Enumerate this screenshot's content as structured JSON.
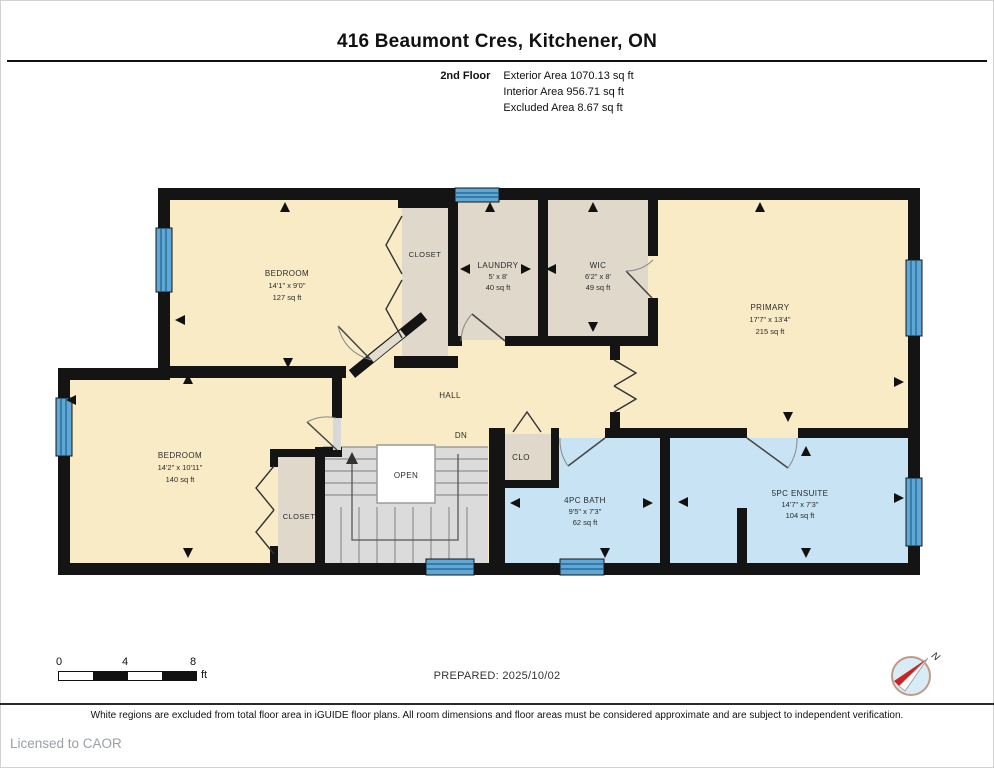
{
  "header": {
    "title": "416 Beaumont Cres, Kitchener, ON",
    "floor_label": "2nd Floor",
    "stats": [
      "Exterior Area 1070.13 sq ft",
      "Interior Area 956.71 sq ft",
      "Excluded Area 8.67 sq ft"
    ]
  },
  "rooms": {
    "bedroom_top": {
      "name": "BEDROOM",
      "dims": "14'1\" x 9'0\"",
      "area": "127 sq ft"
    },
    "closet_top": {
      "name": "CLOSET"
    },
    "laundry": {
      "name": "LAUNDRY",
      "dims": "5' x 8'",
      "area": "40 sq ft"
    },
    "wic": {
      "name": "WIC",
      "dims": "6'2\" x 8'",
      "area": "49 sq ft"
    },
    "primary": {
      "name": "PRIMARY",
      "dims": "17'7\" x 13'4\"",
      "area": "215 sq ft"
    },
    "hall": {
      "name": "HALL"
    },
    "stair_note": "DN",
    "open_label": "OPEN",
    "clo": {
      "name": "CLO"
    },
    "bath": {
      "name": "4PC BATH",
      "dims": "9'5\" x 7'3\"",
      "area": "62 sq ft"
    },
    "ensuite": {
      "name": "5PC ENSUITE",
      "dims": "14'7\" x 7'3\"",
      "area": "104 sq ft"
    },
    "bedroom_bottom": {
      "name": "BEDROOM",
      "dims": "14'2\" x 10'11\"",
      "area": "140 sq ft"
    },
    "closet_bottom": {
      "name": "CLOSET"
    }
  },
  "footer": {
    "scale": {
      "ticks": [
        "0",
        "4",
        "8"
      ],
      "unit": "ft"
    },
    "prepared": "PREPARED: 2025/10/02",
    "compass_label": "N",
    "disclaimer": "White regions are excluded from total floor area in iGUIDE floor plans. All room dimensions and floor areas must be considered approximate and are subject to independent verification.",
    "license": "Licensed to CAOR"
  },
  "colors": {
    "room_fill": "#F8EBC6",
    "closet_fill": "#E0D8CB",
    "bath_fill": "#C8E3F4",
    "stairs_fill": "#DBDBDB",
    "window": "#5FA8D5",
    "wall": "#141414"
  }
}
